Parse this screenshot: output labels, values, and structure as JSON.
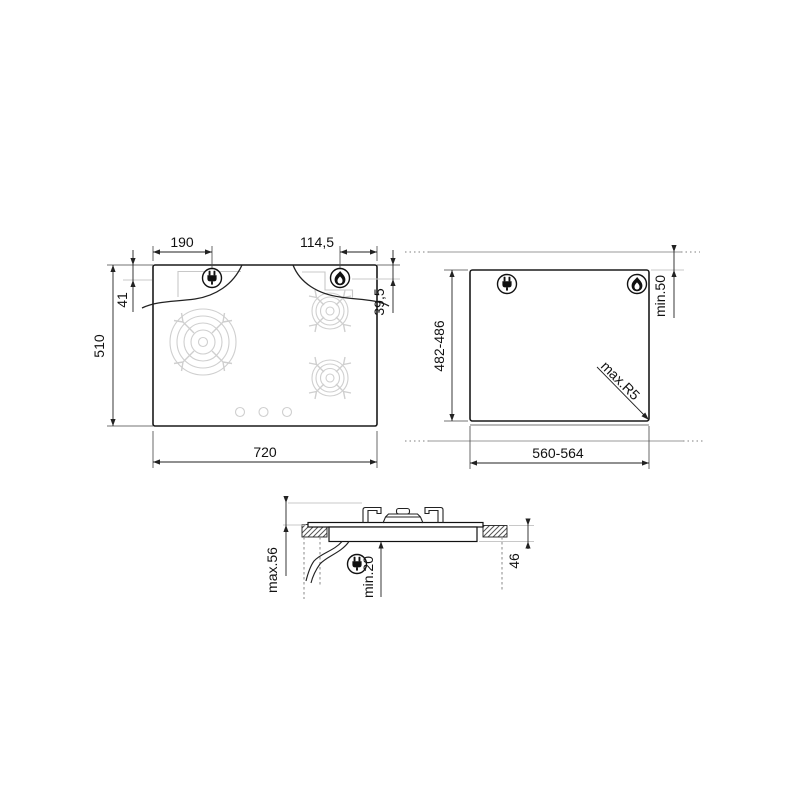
{
  "top_view": {
    "width": "720",
    "height": "510",
    "plug_from_left": "190",
    "plug_from_top": "41",
    "flame_from_right": "114,5",
    "flame_from_top": "39,5"
  },
  "cutout_view": {
    "width": "560-564",
    "height": "482-486",
    "top_clearance": "min.50",
    "corner_radius": "max.R5"
  },
  "section_view": {
    "overall_height": "max.56",
    "bottom_clearance": "min.20",
    "recess_depth": "46"
  },
  "icons": {
    "plug": "power-plug-icon",
    "flame": "gas-flame-icon"
  },
  "colors": {
    "outline": "#1a1a1a",
    "dimension": "#222222",
    "extension_gray": "#c8c8c8",
    "burner_gray": "#cfcfcf",
    "hatch": "#555555",
    "background": "#ffffff"
  }
}
